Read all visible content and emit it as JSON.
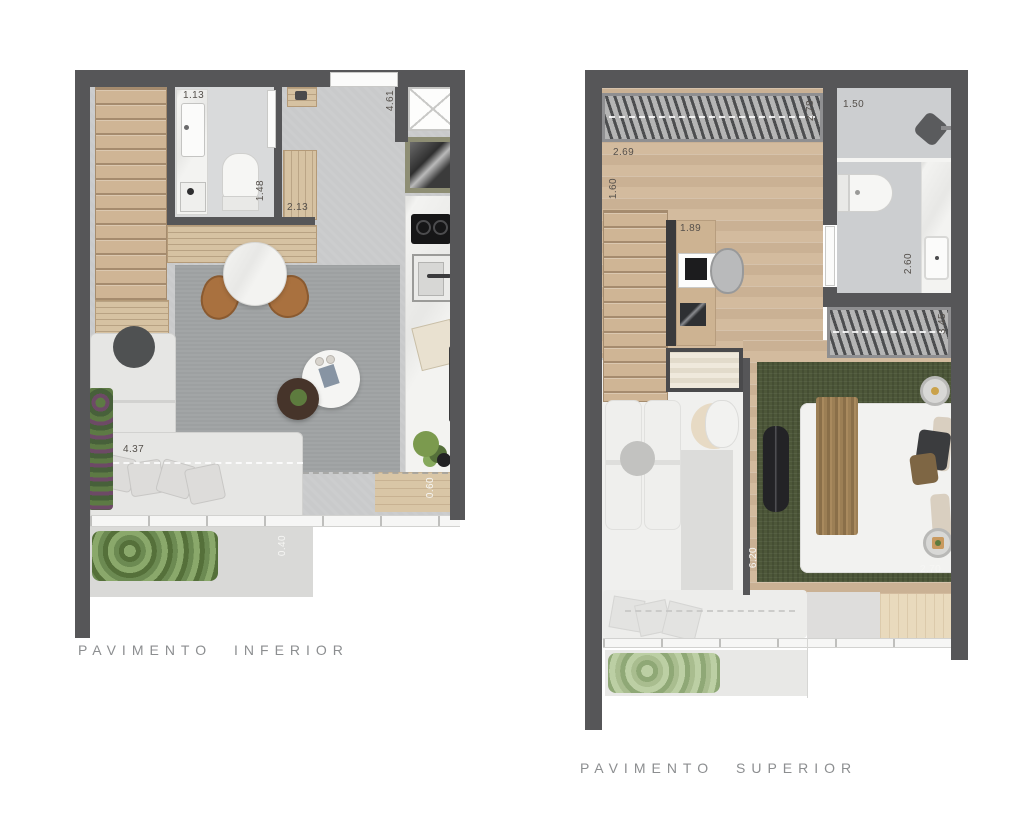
{
  "captions": {
    "lower": "PAVIMENTO INFERIOR",
    "upper": "PAVIMENTO SUPERIOR"
  },
  "plans": {
    "lower": {
      "dimensions": {
        "vanity_width": "1.13",
        "bathroom_depth": "1.48",
        "wardrobe_width": "2.13",
        "kitchen_length": "4.61",
        "sofa_length": "4.37",
        "deck_width": "0.60",
        "planter_width": "0.40"
      }
    },
    "upper": {
      "dimensions": {
        "pergola_length": "2.69",
        "landing_width": "1.60",
        "pergola_depth": "2.78",
        "shower_width": "1.50",
        "desk_length": "1.89",
        "bathroom_depth": "2.60",
        "louver_width": "3.45",
        "bedroom_length": "6.20",
        "bedroom_width": "2.70"
      }
    }
  },
  "colors": {
    "wall": "#565658",
    "wood": "#d3bb9e",
    "concrete": "#c9cacb",
    "rug_gray": "#9da0a1",
    "rug_green": "#4d5739",
    "marble": "#f3f3f1",
    "caption_text": "#8c8e90"
  }
}
